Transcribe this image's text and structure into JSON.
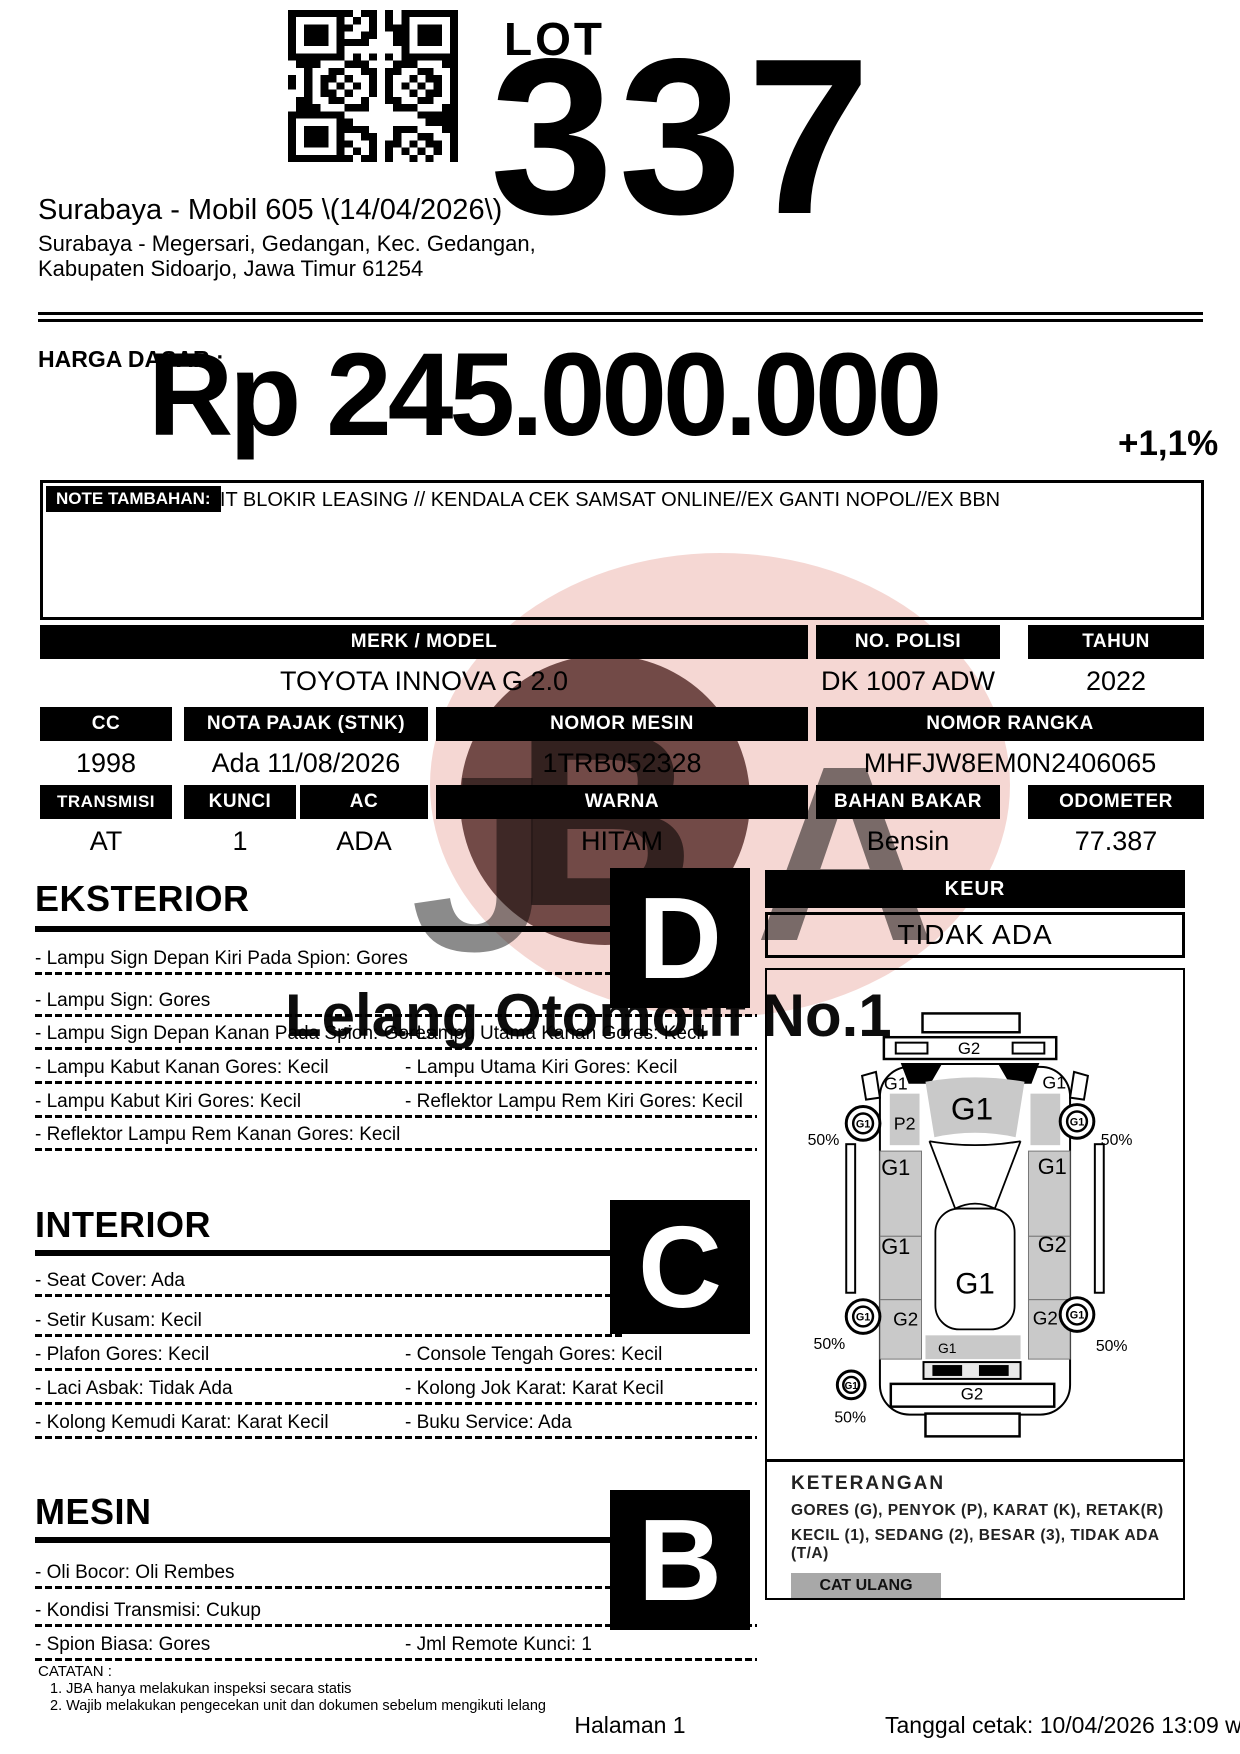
{
  "header": {
    "lot_label": "LOT",
    "lot_number": "337",
    "auction_title": "Surabaya - Mobil 605 \\(14/04/2026\\)",
    "address_line1": "Surabaya - Megersari, Gedangan, Kec. Gedangan,",
    "address_line2": "Kabupaten Sidoarjo, Jawa Timur 61254"
  },
  "price": {
    "label": "HARGA DASAR :",
    "value": "Rp 245.000.000",
    "increment": "+1,1%"
  },
  "note": {
    "label": "NOTE TAMBAHAN:",
    "text": "UNIT BLOKIR LEASING // KENDALA CEK SAMSAT ONLINE//EX GANTI NOPOL//EX BBN"
  },
  "specs": {
    "merk_model": {
      "label": "MERK / MODEL",
      "value": "TOYOTA INNOVA G 2.0"
    },
    "no_polisi": {
      "label": "NO. POLISI",
      "value": "DK 1007 ADW"
    },
    "tahun": {
      "label": "TAHUN",
      "value": "2022"
    },
    "cc": {
      "label": "CC",
      "value": "1998"
    },
    "nota_pajak": {
      "label": "NOTA PAJAK (STNK)",
      "value": "Ada 11/08/2026"
    },
    "nomor_mesin": {
      "label": "NOMOR MESIN",
      "value": "1TRB052328"
    },
    "nomor_rangka": {
      "label": "NOMOR RANGKA",
      "value": "MHFJW8EM0N2406065"
    },
    "transmisi": {
      "label": "TRANSMISI",
      "value": "AT"
    },
    "kunci": {
      "label": "KUNCI",
      "value": "1"
    },
    "ac": {
      "label": "AC",
      "value": "ADA"
    },
    "warna": {
      "label": "WARNA",
      "value": "HITAM"
    },
    "bahan_bakar": {
      "label": "BAHAN BAKAR",
      "value": "Bensin"
    },
    "odometer": {
      "label": "ODOMETER",
      "value": "77.387"
    }
  },
  "sections": {
    "eksterior": {
      "title": "EKSTERIOR",
      "grade": "D",
      "rows": [
        {
          "left": "- Lampu Sign Depan Kiri Pada Spion: Gores",
          "right": ""
        },
        {
          "left": "- Lampu Sign: Gores",
          "right": ""
        },
        {
          "left": "- Lampu Sign Depan Kanan Pada Spion: Gores",
          "right": "- Lampu Utama Kanan Gores: Kecil"
        },
        {
          "left": "- Lampu Kabut Kanan Gores: Kecil",
          "right": "- Lampu Utama Kiri Gores: Kecil"
        },
        {
          "left": "- Lampu Kabut Kiri Gores: Kecil",
          "right": "- Reflektor Lampu Rem Kiri Gores: Kecil"
        },
        {
          "left": "- Reflektor Lampu Rem Kanan Gores: Kecil",
          "right": ""
        }
      ]
    },
    "interior": {
      "title": "INTERIOR",
      "grade": "C",
      "rows": [
        {
          "left": "- Seat Cover: Ada",
          "right": ""
        },
        {
          "left": "- Setir Kusam: Kecil",
          "right": ""
        },
        {
          "left": "- Plafon Gores: Kecil",
          "right": "- Console Tengah Gores: Kecil"
        },
        {
          "left": "- Laci Asbak: Tidak Ada",
          "right": "- Kolong Jok Karat: Karat Kecil"
        },
        {
          "left": "- Kolong Kemudi Karat: Karat Kecil",
          "right": "- Buku Service: Ada"
        }
      ]
    },
    "mesin": {
      "title": "MESIN",
      "grade": "B",
      "rows": [
        {
          "left": "- Oli Bocor: Oli Rembes",
          "right": ""
        },
        {
          "left": "- Kondisi Transmisi: Cukup",
          "right": ""
        },
        {
          "left": "- Spion Biasa: Gores",
          "right": "- Jml Remote Kunci: 1"
        }
      ]
    }
  },
  "keur": {
    "label": "KEUR",
    "value": "TIDAK ADA"
  },
  "diagram": {
    "front_bumper": "G2",
    "rear_bumper": "G2",
    "hood": "G1",
    "roof": "G1",
    "left_mirror": "G1",
    "right_mirror": "G1",
    "left_fender": "P2",
    "left_front_door": "G1",
    "right_front_door": "G1",
    "left_rear_door": "G1",
    "right_rear_door": "G2",
    "left_quarter": "G2",
    "right_quarter": "G2",
    "rear_window": "G1",
    "wheel_front_left": "G1",
    "wheel_front_right": "G1",
    "wheel_rear_left": "G1",
    "wheel_rear_right": "G1",
    "spare_wheel": "G1",
    "pct_front_left": "50%",
    "pct_front_right": "50%",
    "pct_rear_left": "50%",
    "pct_rear_right": "50%",
    "pct_spare": "50%"
  },
  "keterangan": {
    "title": "KETERANGAN",
    "line1": "GORES (G), PENYOK (P), KARAT (K), RETAK(R)",
    "line2": "KECIL (1), SEDANG (2), BESAR (3), TIDAK ADA (T/A)",
    "cat_ulang": "CAT ULANG"
  },
  "catatan": {
    "title": "CATATAN :",
    "items": [
      "1. JBA hanya melakukan inspeksi secara statis",
      "2. Wajib melakukan pengecekan unit dan dokumen sebelum mengikuti lelang"
    ]
  },
  "footer": {
    "page": "Halaman 1",
    "printed": "Tanggal cetak: 10/04/2026 13:09 wib"
  },
  "watermark": {
    "text": "Lelang Otomotif No.1",
    "letters": [
      "J",
      "B",
      "A"
    ]
  },
  "colors": {
    "ink": "#000000",
    "panel_gray": "#c9c9c9",
    "button_gray": "#a8a8a8",
    "watermark_pink": "#f3cdc8",
    "watermark_red": "#401310",
    "watermark_blue": "#8a94c0"
  }
}
